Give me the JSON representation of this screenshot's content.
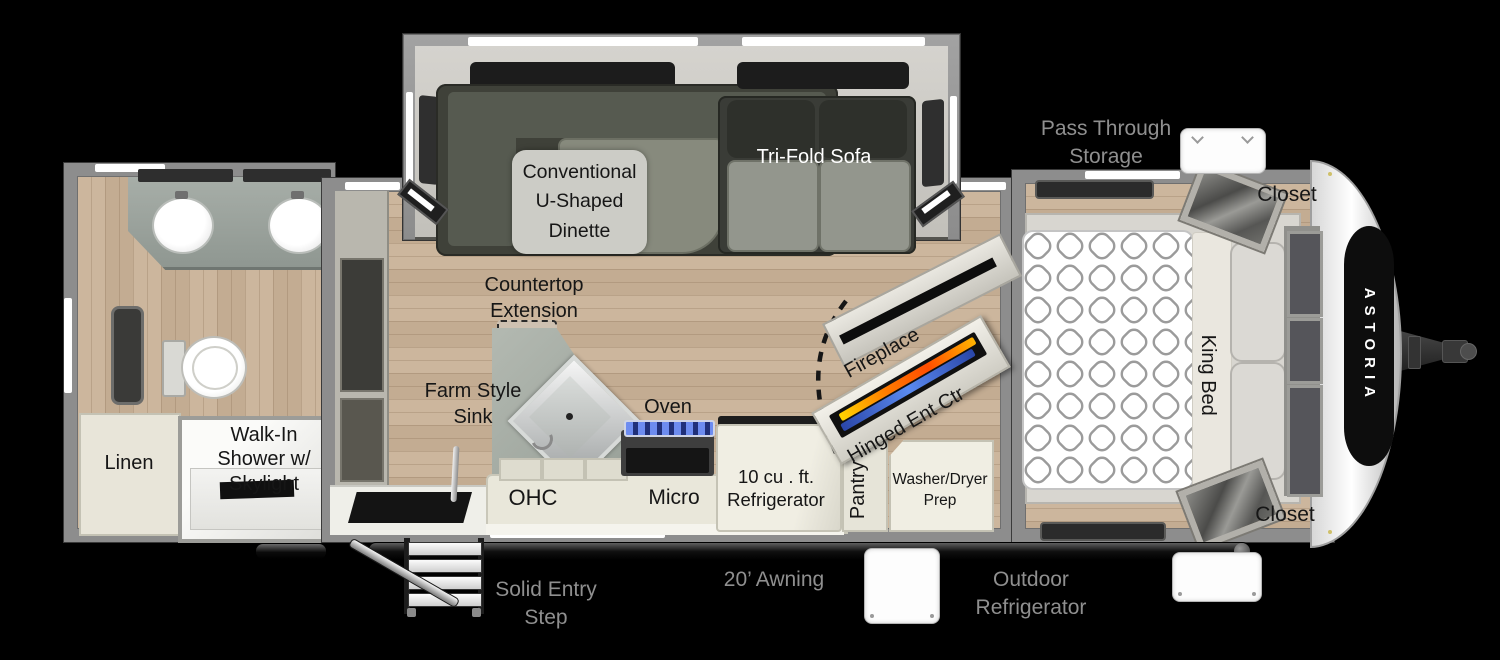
{
  "brand": "ASTORIA",
  "labels": {
    "pass_through_storage": [
      "Pass Through",
      "Storage"
    ],
    "closet_top": "Closet",
    "closet_bottom": "Closet",
    "dinette": [
      "Conventional",
      "U-Shaped",
      "Dinette"
    ],
    "tri_fold_sofa": "Tri-Fold Sofa",
    "countertop_extension": [
      "Countertop",
      "Extension"
    ],
    "farm_style_sink": [
      "Farm Style",
      "Sink"
    ],
    "oven": "Oven",
    "ohc": "OHC",
    "micro": "Micro",
    "refrigerator": [
      "10 cu . ft.",
      "Refrigerator"
    ],
    "pantry": "Pantry",
    "washer_dryer_prep": [
      "Washer/Dryer",
      "Prep"
    ],
    "fireplace": "Fireplace",
    "hinged_ent_ctr": "Hinged Ent Ctr",
    "king_bed": "King Bed",
    "linen": "Linen",
    "walk_in_shower": [
      "Walk-In",
      "Shower w/",
      "Skylight"
    ],
    "solid_entry_step": [
      "Solid Entry",
      "Step"
    ],
    "awning": "20’ Awning",
    "outdoor_refrigerator": [
      "Outdoor",
      "Refrigerator"
    ]
  },
  "colors": {
    "background": "#000000",
    "wall_gray": "#8d8d8d",
    "floor_wood": "#c8b298",
    "counter_cream": "#ece9dd",
    "exterior_label_gray": "#8f8f8f",
    "interior_label_black": "#161616",
    "fireplace_flame_orange": "#ff7a00",
    "fireplace_flame_blue": "#3c64d8",
    "brand_panel_black": "#0d0d0d"
  }
}
